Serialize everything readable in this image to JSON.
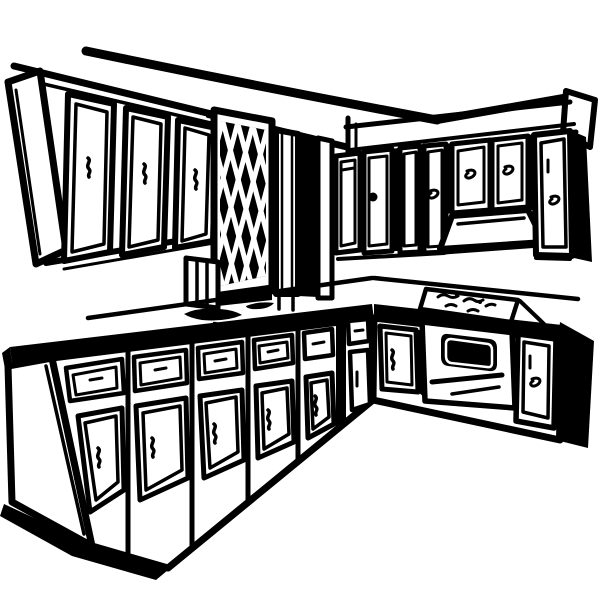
{
  "image": {
    "title": "L-shaped kitchen line drawing",
    "description": "Black and white clipart line drawing of an L-shaped kitchen: upper wall cabinets on two walls, a diamond lattice panel with corner pillar, range hood, oven with dark window and handle, cooktop burner squiggles, sink marks on the countertop, and lower cabinets with drawers and doors",
    "style": "hand-drawn ink clipart",
    "background_color": "#ffffff",
    "ink_color": "#000000"
  },
  "scene": {
    "ceiling_line": {
      "label": "ceiling crown line"
    },
    "upper_left_cabinets": {
      "label": "upper cabinets on left wall",
      "door_count": 3
    },
    "lattice_panel": {
      "label": "diamond lattice panel",
      "pattern": "criss-cross diamonds"
    },
    "pillar": {
      "label": "corner pillar with recess"
    },
    "upper_right_cabinets": {
      "label": "upper cabinets on right wall",
      "door_count": 7
    },
    "range_hood": {
      "label": "range hood under short cabinets"
    },
    "countertop": {
      "label": "L-shaped countertop with black front edge band"
    },
    "sink": {
      "label": "sink basin marks on counter"
    },
    "cooktop": {
      "label": "cooktop with burner squiggles",
      "burner_count": 4
    },
    "oven": {
      "label": "oven with dark window and two handle bars"
    },
    "lower_left_cabinets": {
      "label": "lower cabinets, left run",
      "drawer_count": 6,
      "door_count": 6
    },
    "lower_right_cabinets": {
      "label": "lower cabinets, right run",
      "door_count": 2
    }
  }
}
